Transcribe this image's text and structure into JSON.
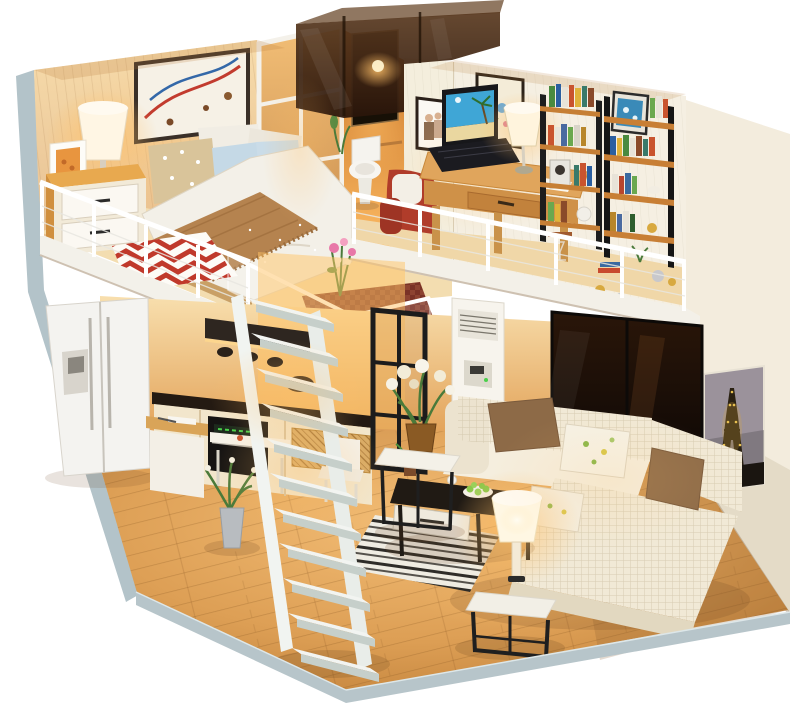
{
  "meta": {
    "subject": "DIY miniature dollhouse loft apartment, warm-lit interior, product photo on white background",
    "canvas_width": 800,
    "canvas_height": 721
  },
  "scene": {
    "background": "#ffffff"
  },
  "palette": {
    "exterior_wall": "#b3c3c9",
    "base_edge": "#b7c5ca",
    "white_wall": "#f3ecdd",
    "wood_wall": "#f0cf9e",
    "wood_floor": "#d99a4e",
    "warm_glow": "#ffc068",
    "stair_white": "#f2f4f1",
    "railing_white": "#ffffff",
    "sofa_cream": "#f1e9d6",
    "pillow_brown": "#8d6a47",
    "pillow_blue": "#c5d9e6",
    "blanket_brown": "#b5834f",
    "accent_red": "#b03c2a",
    "rug_red": "#c0392b",
    "furniture_black": "#201a14",
    "shelf_wood": "#c67f35",
    "fridge_white": "#f4f3f0",
    "ac_white": "#f7f4ed",
    "lamp_glow": "#ffd791",
    "eiffel_sky": "#9b929b",
    "laptop_sky": "#3fa6d6"
  },
  "rooms": {
    "bedroom_loft": {
      "name": "bedroom-loft",
      "furniture": [
        "wall-art",
        "bedside-lamp",
        "photo-frame",
        "nightstand",
        "double-bed",
        "zigzag-rug",
        "pixel-rug",
        "glass-balustrade",
        "flower-bouquet",
        "loft-railing"
      ]
    },
    "bathroom": {
      "name": "bathroom",
      "furniture": [
        "tinted-glass-cube",
        "mirror",
        "toilet",
        "shoji-door",
        "plant"
      ]
    },
    "study_loft": {
      "name": "study-loft",
      "furniture": [
        "partition-wall",
        "couple-photo",
        "butterfly-art",
        "red-armchair",
        "desk",
        "laptop",
        "desk-lamp",
        "wood-ladder-bookshelf",
        "black-ladder-bookshelf",
        "books",
        "ornaments",
        "loft-railing"
      ]
    },
    "kitchen": {
      "name": "kitchen",
      "furniture": [
        "fridge",
        "range-hood",
        "hanging-pots",
        "counter",
        "oven",
        "rattan-baskets",
        "prep-table",
        "dining-table",
        "chair"
      ]
    },
    "living_room": {
      "name": "living-room",
      "furniture": [
        "floor-ac-unit",
        "glass-partition",
        "dark-sliding-doors",
        "eiffel-tower-poster",
        "sectional-sofa",
        "throw-pillows",
        "coffee-table",
        "striped-rug",
        "side-table",
        "glowing-table-lamp",
        "flower-side-table",
        "floor-plant"
      ]
    },
    "staircase": {
      "name": "staircase",
      "steps": 11
    }
  }
}
